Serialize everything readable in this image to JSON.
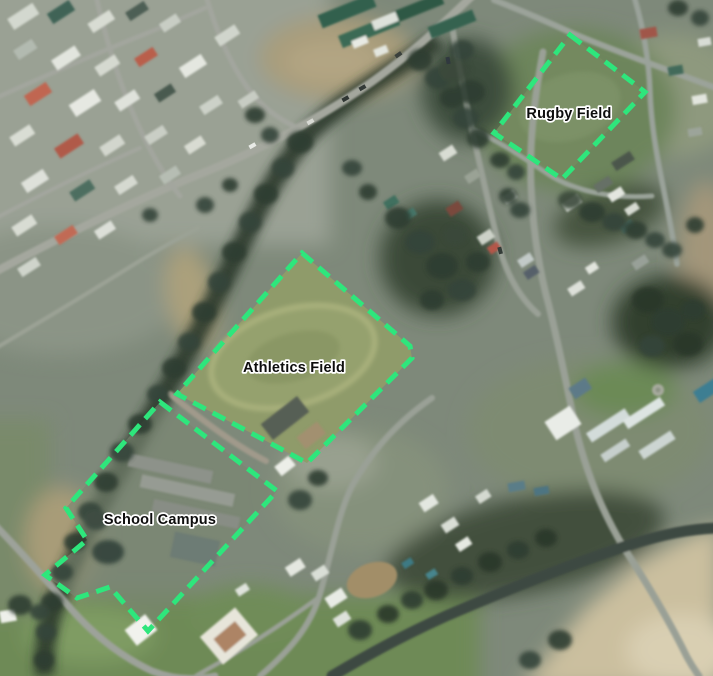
{
  "canvas": {
    "width": 713,
    "height": 676
  },
  "style": {
    "boundary_color": "#2ee67c",
    "label_color": "#0d0d0d",
    "label_halo_color": "#ffffff"
  },
  "features": [
    {
      "name": "Rugby Field",
      "points": "570,35 645,92 562,179 494,133",
      "label_x": 569,
      "label_y": 118
    },
    {
      "name": "Athletics Field",
      "points": "302,253 410,346 412,358 307,463 268,442 177,394",
      "label_x": 294,
      "label_y": 372
    },
    {
      "name": "School Campus",
      "points": "160,402 277,491 148,631 110,587 77,598 45,575 87,540 66,508",
      "label_x": 160,
      "label_y": 524
    }
  ]
}
